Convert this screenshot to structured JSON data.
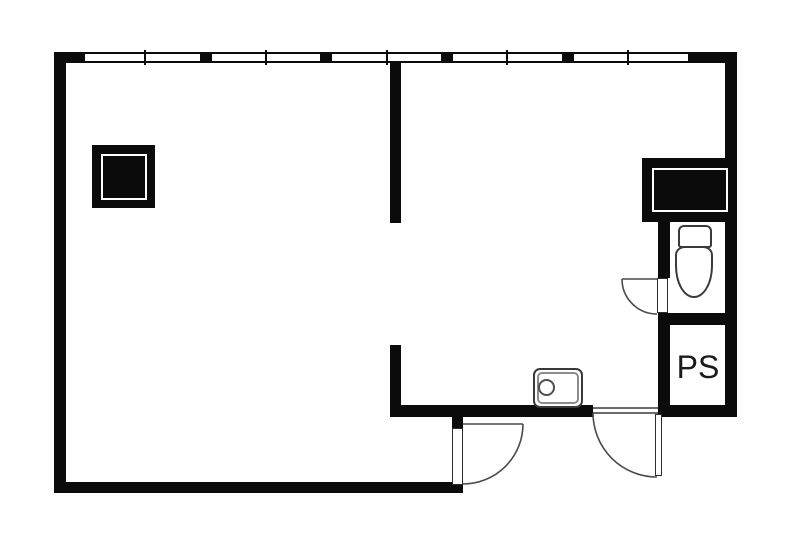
{
  "label": {
    "text": "PS"
  },
  "colors": {
    "wall": "#0b0b0b",
    "fixture_outline": "#3a3a3a",
    "door_line": "#4a4a4a",
    "background": "#ffffff",
    "text": "#1b1b1b"
  },
  "canvas": {
    "width": 787,
    "height": 538
  },
  "walls": [
    {
      "name": "outer-wall-top",
      "x": 54,
      "y": 52,
      "w": 683,
      "h": 11
    },
    {
      "name": "outer-wall-left",
      "x": 54,
      "y": 52,
      "w": 12,
      "h": 441
    },
    {
      "name": "outer-wall-right",
      "x": 725,
      "y": 52,
      "w": 12,
      "h": 365
    },
    {
      "name": "outer-wall-bottom",
      "x": 54,
      "y": 482,
      "w": 409,
      "h": 11
    },
    {
      "name": "partition-wall-upper",
      "x": 390,
      "y": 62,
      "w": 11,
      "h": 161
    },
    {
      "name": "partition-wall-lower",
      "x": 390,
      "y": 345,
      "w": 11,
      "h": 72
    },
    {
      "name": "south-wall-left-of-entry",
      "x": 390,
      "y": 405,
      "w": 203,
      "h": 12
    },
    {
      "name": "south-wall-under-ps",
      "x": 658,
      "y": 405,
      "w": 79,
      "h": 12
    },
    {
      "name": "wc-wall-upper",
      "x": 658,
      "y": 222,
      "w": 12,
      "h": 56
    },
    {
      "name": "wc-ps-wall-lower",
      "x": 658,
      "y": 313,
      "w": 12,
      "h": 104
    },
    {
      "name": "wc-ps-divider-wall",
      "x": 658,
      "y": 313,
      "w": 79,
      "h": 12
    },
    {
      "name": "entry-door-stub",
      "x": 452,
      "y": 417,
      "w": 11,
      "h": 11
    }
  ],
  "window": {
    "band": {
      "x": 85,
      "y": 52,
      "w": 603,
      "h": 11
    },
    "mullion_size": {
      "y": 52,
      "w": 12,
      "h": 11
    },
    "mullions": [
      {
        "x": 200
      },
      {
        "x": 320
      },
      {
        "x": 441
      },
      {
        "x": 562
      }
    ],
    "tick_size": {
      "y": 50,
      "w": 2,
      "h": 15
    },
    "ticks": [
      {
        "x": 144
      },
      {
        "x": 265
      },
      {
        "x": 386
      },
      {
        "x": 506
      },
      {
        "x": 627
      }
    ]
  },
  "shafts": [
    {
      "name": "service-shaft",
      "outer": {
        "x": 642,
        "y": 158,
        "w": 95,
        "h": 64
      },
      "inset": {
        "x": 10,
        "y": 10,
        "w": 76,
        "h": 44
      }
    },
    {
      "name": "column",
      "outer": {
        "x": 92,
        "y": 145,
        "w": 63,
        "h": 63
      },
      "inset": {
        "x": 9,
        "y": 9,
        "w": 46,
        "h": 46
      }
    }
  ],
  "fixtures": {
    "toilet": {
      "bowl": {
        "x": 675,
        "y": 246,
        "w": 38,
        "h": 52
      },
      "tank": {
        "x": 678,
        "y": 225,
        "w": 34,
        "h": 23
      }
    },
    "sink": {
      "outer": {
        "x": 533,
        "y": 368,
        "w": 50,
        "h": 40
      },
      "inner": {
        "x": 537,
        "y": 372,
        "w": 42,
        "h": 32
      },
      "drain": {
        "x": 538,
        "y": 379,
        "w": 17,
        "h": 17
      }
    }
  },
  "doors": [
    {
      "name": "entry-door",
      "leaf": {
        "x": 452,
        "y": 428,
        "w": 11,
        "h": 57
      },
      "line": "M 463 424 L 523 424",
      "arc": "M 523 424 A 60 60 0 0 1 463 484"
    },
    {
      "name": "service-entry-door",
      "leaf": {
        "x": 655,
        "y": 414,
        "w": 7,
        "h": 62
      },
      "line": null,
      "arc": "M 593 413 A 64 64 0 0 0 657 477"
    },
    {
      "name": "wc-door",
      "leaf": {
        "x": 657,
        "y": 278,
        "w": 11,
        "h": 35
      },
      "line": "M 622 279 L 657 279",
      "arc": "M 622 279 A 35 35 0 0 0 657 314"
    }
  ],
  "gap_lines": [
    {
      "name": "entry-threshold-line-top",
      "x": 593,
      "y": 407,
      "w": 65,
      "h": 2
    },
    {
      "name": "entry-threshold-line-bottom",
      "x": 593,
      "y": 412,
      "w": 65,
      "h": 2
    }
  ],
  "ps_label_box": {
    "x": 670,
    "y": 350,
    "w": 56,
    "h": 34
  }
}
